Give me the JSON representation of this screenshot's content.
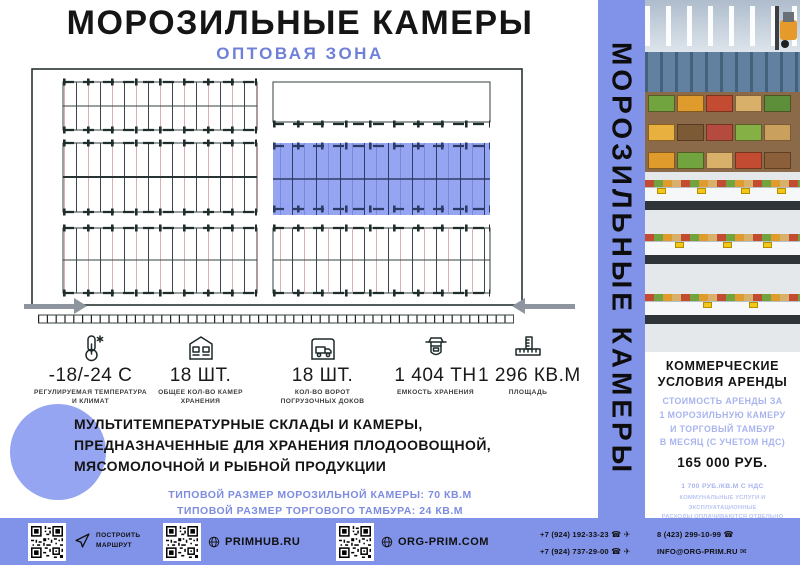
{
  "header": {
    "title": "МОРОЗИЛЬНЫЕ КАМЕРЫ",
    "subtitle": "ОПТОВАЯ ЗОНА"
  },
  "colors": {
    "accent": "#8193E9",
    "subtitle_blue": "#6F80D8",
    "plan_highlight": "#96A5F1",
    "circle": "#96A5F1",
    "arrow_gray": "#8E959E",
    "light_blue_text": "#A9B4EF"
  },
  "stats": [
    {
      "icon": "thermometer-icon",
      "value": "-18/-24 C",
      "caption1": "РЕГУЛИРУЕМАЯ ТЕМПЕРАТУРА",
      "caption2": "И КЛИМАТ"
    },
    {
      "icon": "warehouse-icon",
      "value": "18 ШТ.",
      "caption1": "ОБЩЕЕ КОЛ-ВО КАМЕР",
      "caption2": "ХРАНЕНИЯ"
    },
    {
      "icon": "dock-truck-icon",
      "value": "18 ШТ.",
      "caption1": "КОЛ-ВО ВОРОТ",
      "caption2": "ПОГРУЗОЧНЫХ ДОКОВ"
    },
    {
      "icon": "scale-icon",
      "value": "1 404 ТН",
      "caption1": "ЕМКОСТЬ ХРАНЕНИЯ",
      "caption2": ""
    },
    {
      "icon": "ruler-icon",
      "value": "1 296 КВ.М",
      "caption1": "ПЛОЩАДЬ",
      "caption2": ""
    }
  ],
  "description": {
    "line1": "МУЛЬТИТЕМПЕРАТУРНЫЕ СКЛАДЫ И КАМЕРЫ,",
    "line2": "ПРЕДНАЗНАЧЕННЫЕ ДЛЯ ХРАНЕНИЯ ПЛОДООВОЩНОЙ,",
    "line3": "МЯСОМОЛОЧНОЙ И РЫБНОЙ ПРОДУКЦИИ"
  },
  "typical": {
    "line1": "ТИПОВОЙ РАЗМЕР МОРОЗИЛЬНОЙ КАМЕРЫ: 70 КВ.М",
    "line2": "ТИПОВОЙ РАЗМЕР ТОРГОВОГО ТАМБУРА: 24 КВ.М"
  },
  "sidebar": {
    "vertical_title": "МОРОЗИЛЬНЫЕ КАМЕРЫ"
  },
  "offer": {
    "heading1": "КОММЕРЧЕСКИЕ",
    "heading2": "УСЛОВИЯ АРЕНДЫ",
    "terms": [
      "СТОИМОСТЬ АРЕНДЫ ЗА",
      "1 МОРОЗИЛЬНУЮ КАМЕРУ",
      "И ТОРГОВЫЙ ТАМБУР",
      "В МЕСЯЦ (С УЧЕТОМ НДС)"
    ],
    "price": "165 000 РУБ.",
    "rate": "1 700 РУБ./КВ.М С НДС",
    "note1": "КОММУНАЛЬНЫЕ УСЛУГИ И ЭКСПЛУАТАЦИОННЫЕ",
    "note2": "РАСХОДЫ ОПЛАЧИВАЮТСЯ ОТДЕЛЬНО"
  },
  "footer": {
    "route_label1": "ПОСТРОИТЬ",
    "route_label2": "МАРШРУТ",
    "site1": "PRIMHUB.RU",
    "site2": "ORG-PRIM.COM",
    "phone_mobile1": "+7 (924) 192-33-23",
    "phone_mobile2": "+7 (924) 737-29-00",
    "phone_city": "8 (423) 299-10-99",
    "email": "INFO@ORG-PRIM.RU"
  }
}
